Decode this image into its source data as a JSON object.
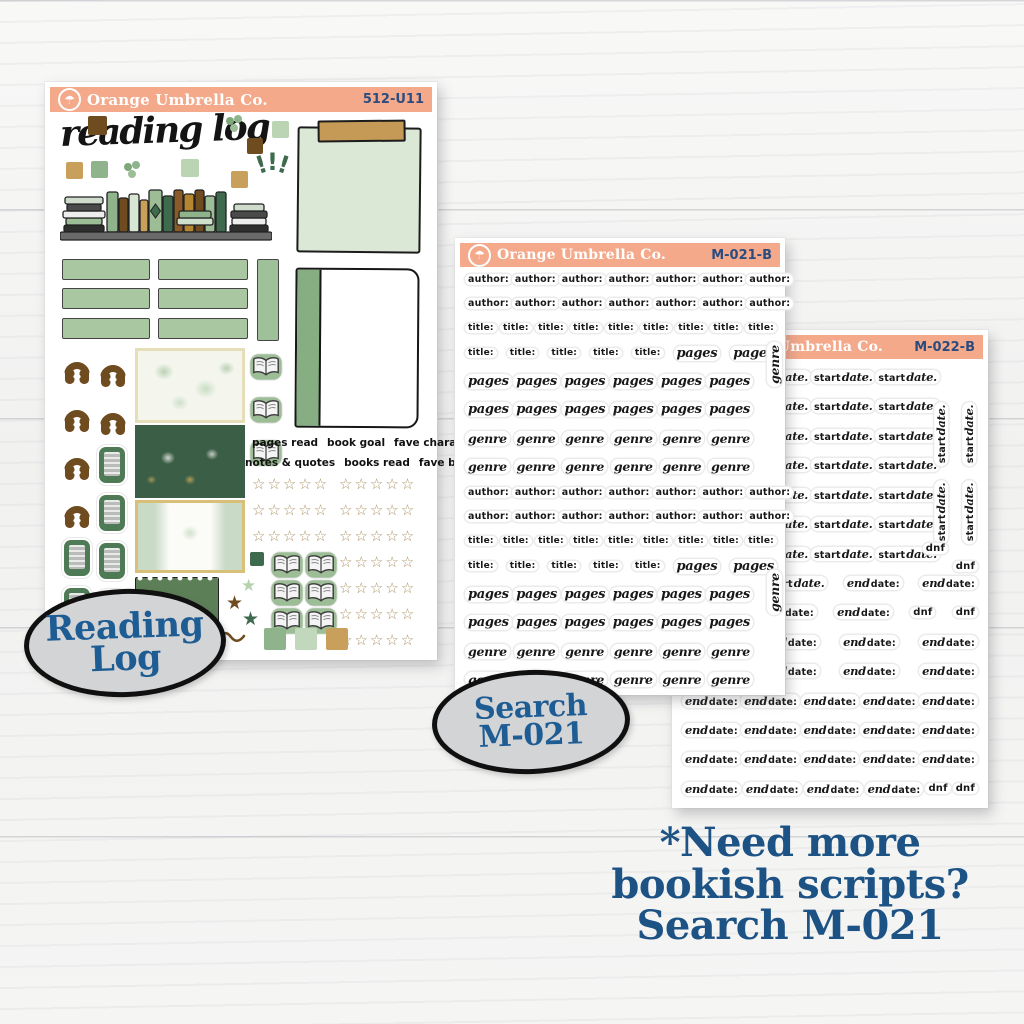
{
  "colors": {
    "header_peach": "#F4A98B",
    "navy_text": "#1E5488",
    "sage_green": "#A9C7A1",
    "dark_green": "#3E6B4E",
    "brown": "#6F4B20",
    "tan": "#C9A05B",
    "badge_gray": "#D3D4D6",
    "star_gold": "#AD9468"
  },
  "icons": {
    "umbrella": "☂",
    "star_outline": "☆",
    "star_filled": "★",
    "exclaim_char": "!"
  },
  "kit": {
    "brand": "Orange Umbrella Co.",
    "code": "512-U11",
    "title": "reading log",
    "labels_row1": [
      "pages read",
      "book goal",
      "fave character"
    ],
    "labels_row2": [
      "notes & quotes",
      "books read",
      "fave book"
    ],
    "rating": {
      "left_rows": 3,
      "right_rows": 7,
      "stars_per_row": 5,
      "star_char": "☆"
    }
  },
  "m021": {
    "brand": "Orange Umbrella Co.",
    "code": "M-021-B",
    "vertical": [
      "genre",
      "genre"
    ],
    "rows": [
      [
        "author",
        "author",
        "author",
        "author",
        "author",
        "author",
        "author"
      ],
      [
        "author",
        "author",
        "author",
        "author",
        "author",
        "author",
        "author"
      ],
      [
        "title",
        "title",
        "title",
        "title",
        "title",
        "title",
        "title",
        "title",
        "title"
      ],
      [
        "title",
        "title",
        "title",
        "title",
        "title",
        "pages",
        "pages"
      ],
      [
        "pages",
        "pages",
        "pages",
        "pages",
        "pages",
        "pages"
      ],
      [
        "pages",
        "pages",
        "pages",
        "pages",
        "pages",
        "pages"
      ],
      [
        "genre",
        "genre",
        "genre",
        "genre",
        "genre",
        "genre"
      ],
      [
        "genre",
        "genre",
        "genre",
        "genre",
        "genre",
        "genre"
      ],
      [
        "author",
        "author",
        "author",
        "author",
        "author",
        "author",
        "author"
      ],
      [
        "author",
        "author",
        "author",
        "author",
        "author",
        "author",
        "author"
      ],
      [
        "title",
        "title",
        "title",
        "title",
        "title",
        "title",
        "title",
        "title",
        "title"
      ],
      [
        "title",
        "title",
        "title",
        "title",
        "title",
        "pages",
        "pages"
      ],
      [
        "pages",
        "pages",
        "pages",
        "pages",
        "pages",
        "pages"
      ],
      [
        "pages",
        "pages",
        "pages",
        "pages",
        "pages",
        "pages"
      ],
      [
        "genre",
        "genre",
        "genre",
        "genre",
        "genre",
        "genre"
      ],
      [
        "genre",
        "genre",
        "genre",
        "genre",
        "genre",
        "genre"
      ]
    ]
  },
  "m022": {
    "brand": "Orange Umbrella Co.",
    "code": "M-022-B",
    "vertical": [
      "startdate",
      "startdate",
      "startdate",
      "startdate"
    ],
    "rows": [
      [
        "startdate",
        "startdate",
        "startdate",
        "startdate"
      ],
      [
        "startdate",
        "startdate",
        "startdate",
        "startdate"
      ],
      [
        "startdate",
        "startdate",
        "startdate",
        "startdate"
      ],
      [
        "startdate",
        "startdate",
        "startdate",
        "startdate"
      ],
      [
        "startdate",
        "startdate",
        "startdate",
        "startdate"
      ],
      [
        "startdate",
        "startdate",
        "startdate",
        "startdate"
      ],
      [
        "startdate",
        "startdate",
        "startdate",
        "startdate"
      ],
      [
        "startdate",
        "startdate",
        "enddate",
        "enddate"
      ],
      [
        "enddate",
        "enddate",
        "enddate",
        "dnf",
        "dnf"
      ],
      [
        "enddate",
        "enddate",
        "enddate",
        "enddate"
      ],
      [
        "enddate",
        "enddate",
        "enddate",
        "enddate"
      ],
      [
        "enddate",
        "enddate",
        "enddate",
        "enddate",
        "enddate"
      ],
      [
        "enddate",
        "enddate",
        "enddate",
        "enddate",
        "enddate"
      ],
      [
        "enddate",
        "enddate",
        "enddate",
        "enddate",
        "enddate"
      ],
      [
        "enddate",
        "enddate",
        "enddate",
        "enddate",
        "dnf",
        "dnf"
      ]
    ]
  },
  "stickers": {
    "author": [
      [
        "author:",
        "p"
      ]
    ],
    "title": [
      [
        "title:",
        "p"
      ]
    ],
    "pages": [
      [
        "pages",
        "s"
      ]
    ],
    "genre": [
      [
        "genre",
        "s"
      ]
    ],
    "startdate": [
      [
        "start",
        "p"
      ],
      [
        "date.",
        "s"
      ]
    ],
    "enddate": [
      [
        "end",
        "s"
      ],
      [
        "date:",
        "p"
      ]
    ],
    "dnf": [
      [
        "dnf",
        "p"
      ]
    ]
  },
  "badges": {
    "reading_log": [
      "Reading",
      "Log"
    ],
    "search": [
      "Search",
      "M-021"
    ]
  },
  "footer": [
    "*Need more",
    "bookish scripts?",
    "Search M-021"
  ]
}
